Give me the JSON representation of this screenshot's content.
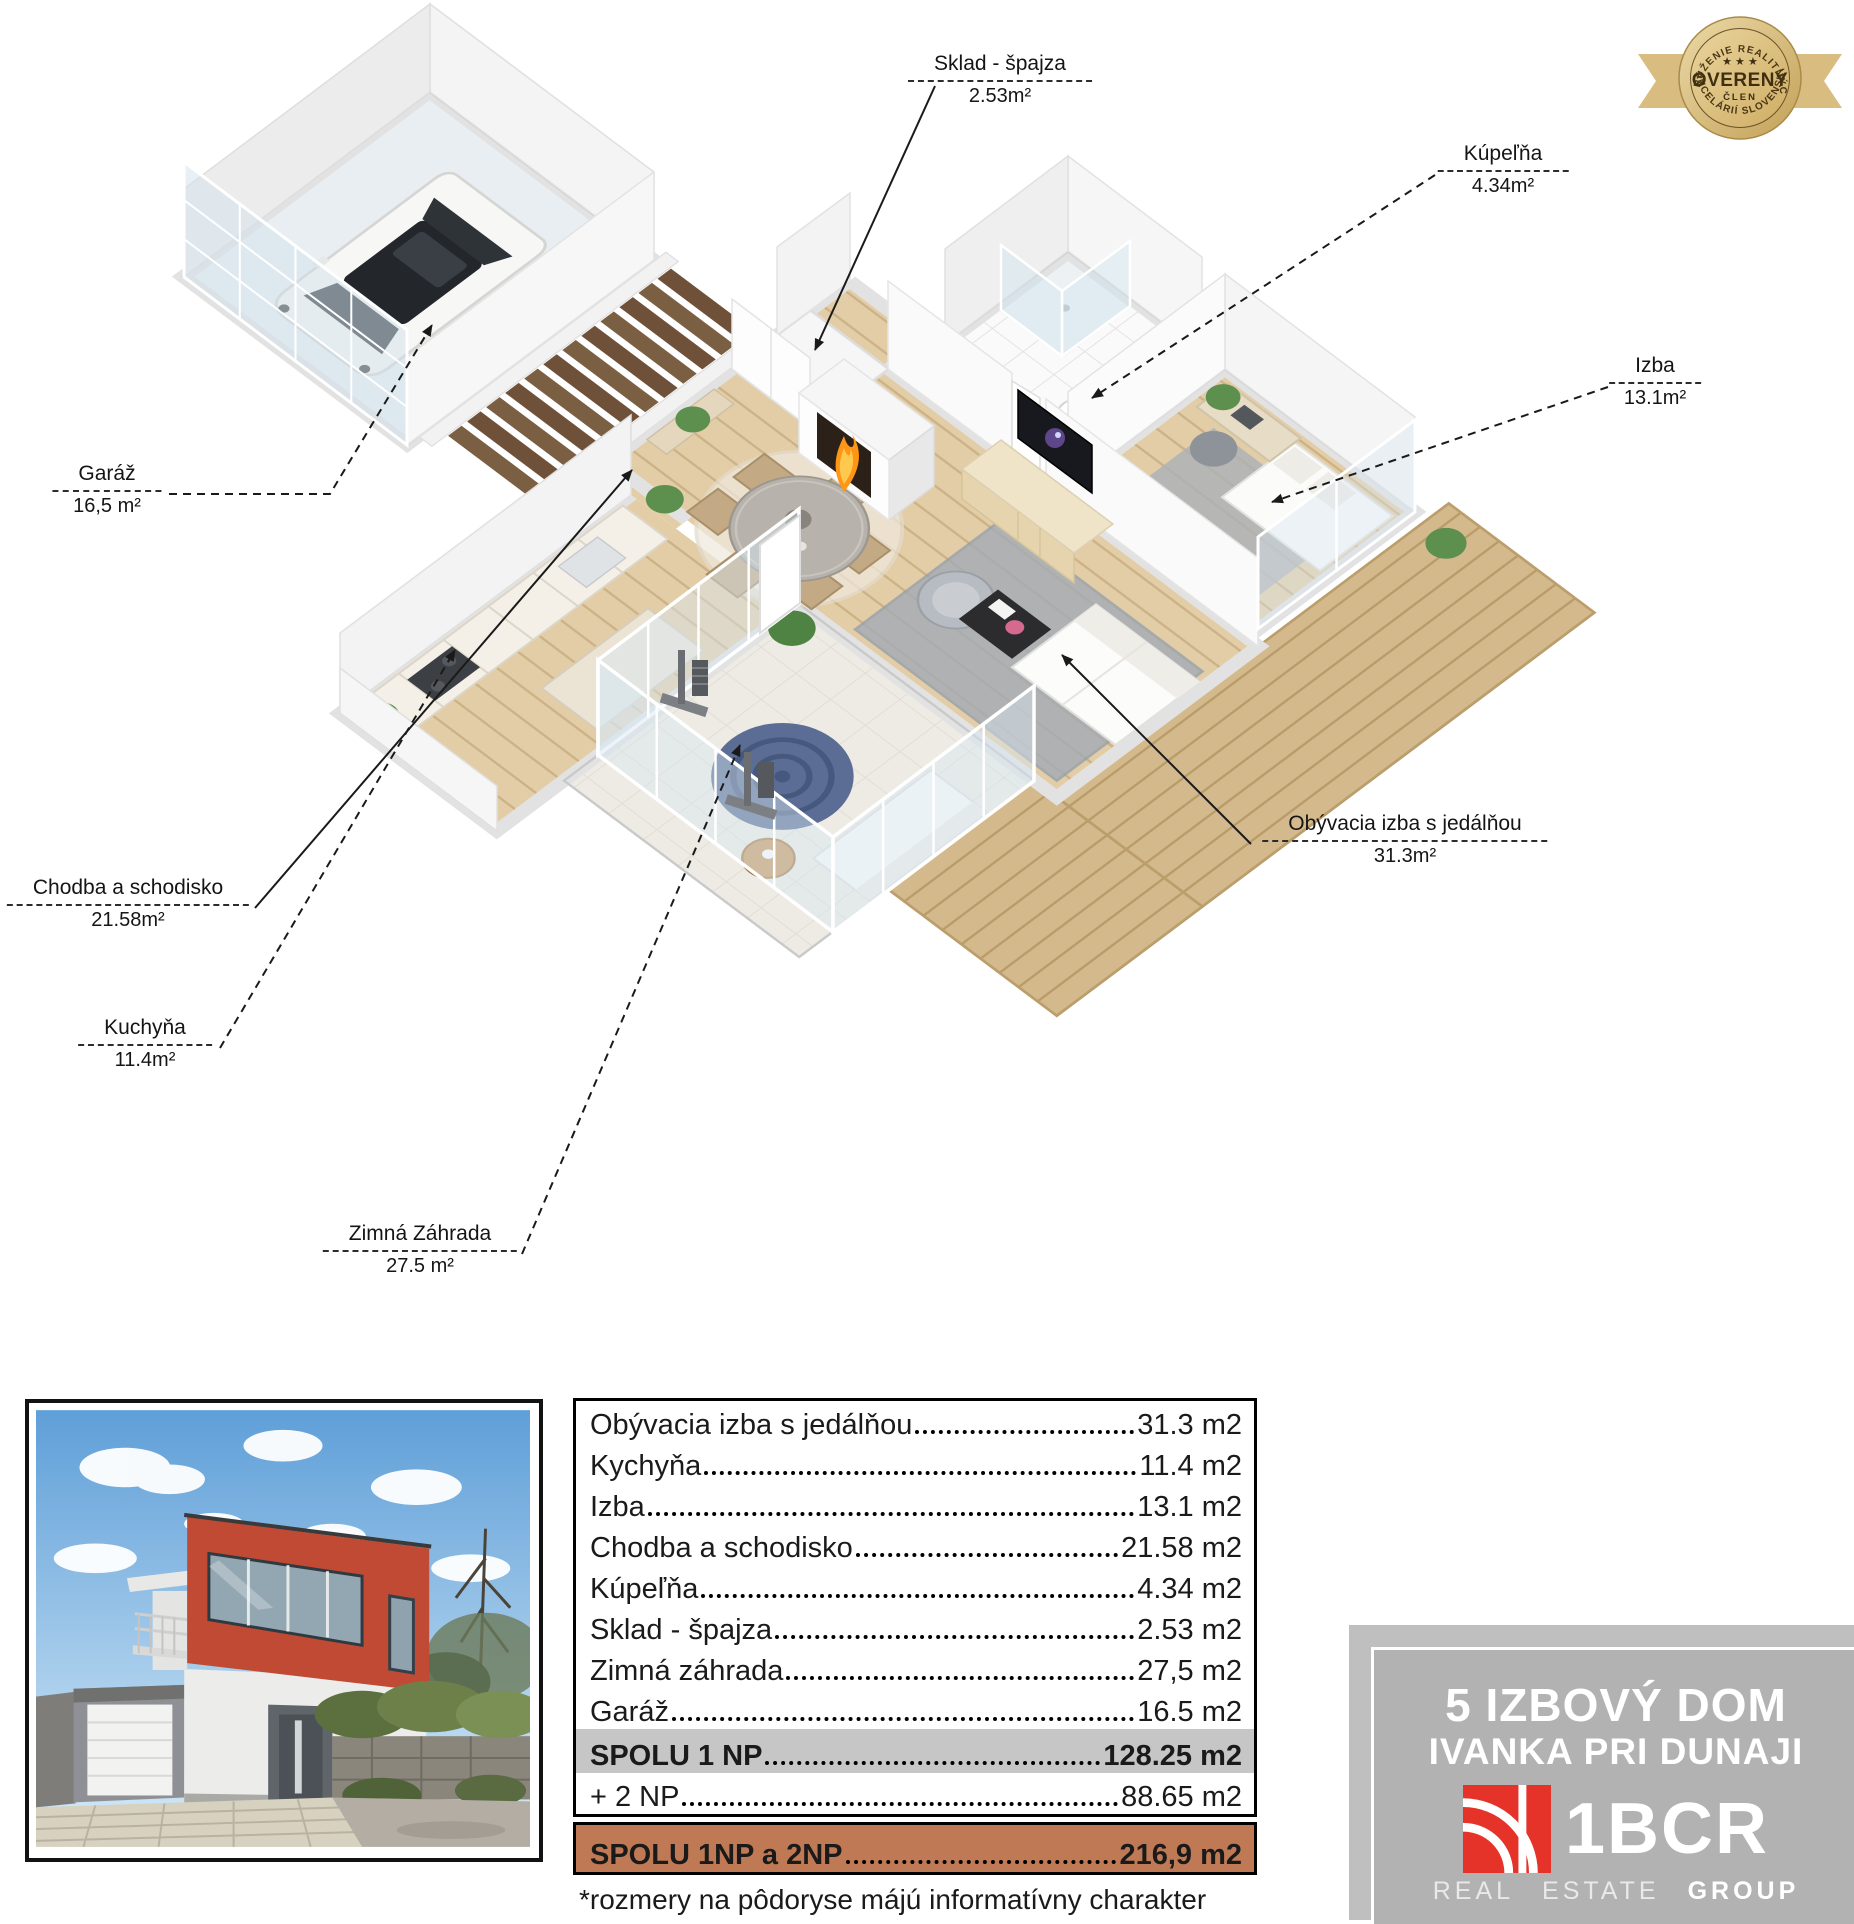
{
  "badge": {
    "arc_top": "ZDRUŽENIE REALITNÝCH",
    "stars": "★ ★ ★",
    "title": "OVERENÝ",
    "subtitle": "ČLEN",
    "arc_bottom": "KANCELÁRIÍ SLOVENSKA"
  },
  "callouts": [
    {
      "id": "sklad",
      "name": "Sklad - špajza",
      "area": "2.53m²"
    },
    {
      "id": "kupelna",
      "name": "Kúpeľňa",
      "area": "4.34m²"
    },
    {
      "id": "izba",
      "name": "Izba",
      "area": "13.1m²"
    },
    {
      "id": "garaz",
      "name": "Garáž",
      "area": "16,5 m²"
    },
    {
      "id": "chodba",
      "name": "Chodba a schodisko",
      "area": "21.58m²"
    },
    {
      "id": "kuchyna",
      "name": "Kuchyňa",
      "area": "11.4m²"
    },
    {
      "id": "obyvacia",
      "name": "Obývacia izba s jedálňou",
      "area": "31.3m²"
    },
    {
      "id": "zimna",
      "name": "Zimná Záhrada",
      "area": "27.5 m²"
    }
  ],
  "table": {
    "rows": [
      {
        "label": "Obývacia izba s jedálňou",
        "value": "31.3 m2"
      },
      {
        "label": "Kychyňa",
        "value": "11.4 m2"
      },
      {
        "label": "Izba",
        "value": "13.1 m2"
      },
      {
        "label": "Chodba a schodisko",
        "value": "21.58 m2"
      },
      {
        "label": "Kúpeľňa",
        "value": "4.34 m2"
      },
      {
        "label": "Sklad - špajza",
        "value": "2.53 m2"
      },
      {
        "label": "Zimná záhrada",
        "value": "27,5 m2"
      },
      {
        "label": "Garáž",
        "value": "16.5 m2"
      }
    ],
    "total_1np": {
      "label": "SPOLU 1 NP",
      "value": "128.25 m2"
    },
    "plus_2np": {
      "label": "+ 2 NP",
      "value": "88.65 m2"
    },
    "total_all": {
      "label": "SPOLU 1NP a 2NP",
      "value": "216,9 m2"
    },
    "footnote": "*rozmery na pôdoryse májú informatívny charakter"
  },
  "branding": {
    "line1": "5 IZBOVÝ DOM",
    "line2": "IVANKA PRI DUNAJI",
    "logo": "1BCR",
    "tag1": "REAL",
    "tag2": "ESTATE",
    "tag3": "GROUP"
  },
  "colors": {
    "accent_brown": "#bf7a55",
    "total_gray": "#c6c6c6",
    "brand_gray": "#b2b2b2",
    "logo_red": "#e5332a",
    "badge_gold": "#d3b06a",
    "wood_floor": "#e3cda6",
    "deck": "#d3b98c"
  }
}
